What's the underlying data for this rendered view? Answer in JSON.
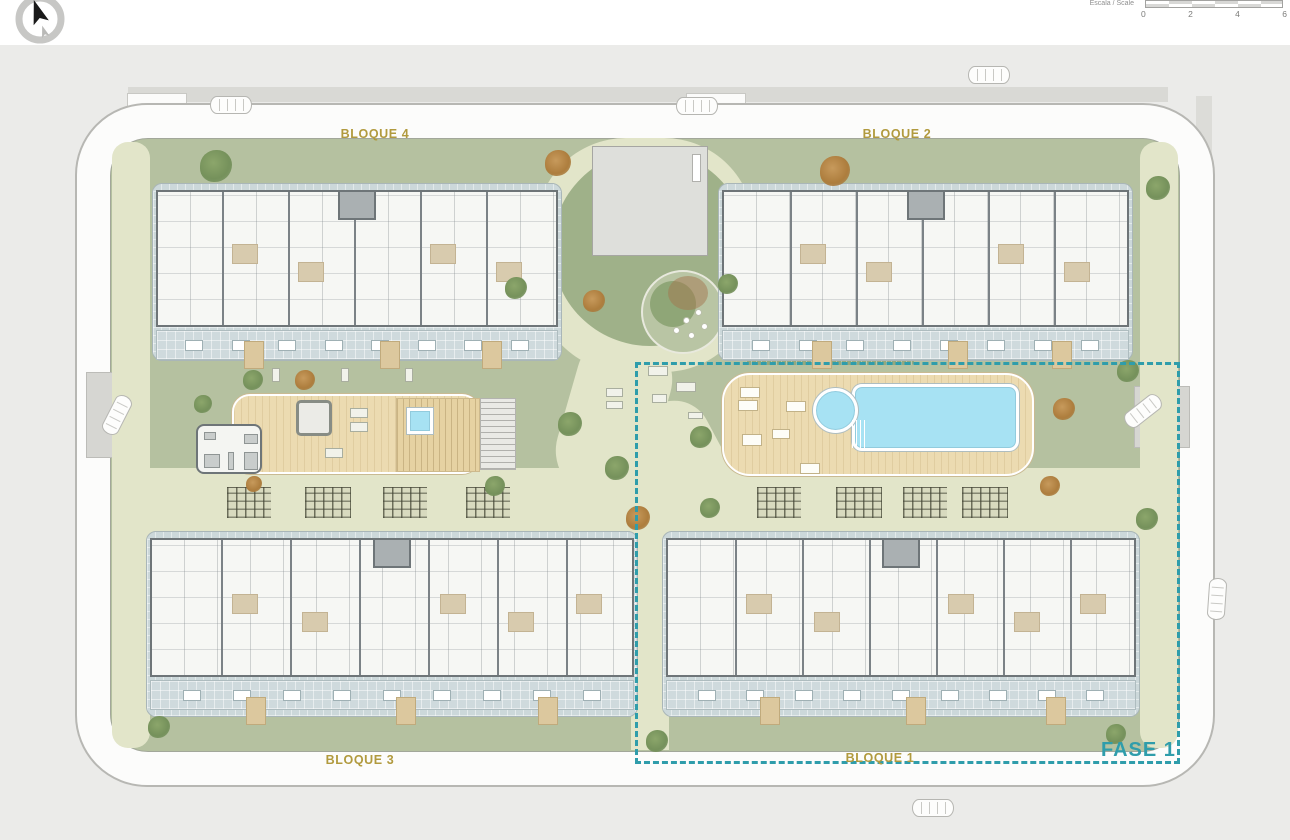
{
  "toolbar": {
    "compass_icon": "north-arrow",
    "scale": {
      "label": "Escala / Scale",
      "ticks": [
        "0",
        "2",
        "4",
        "6"
      ]
    }
  },
  "plan": {
    "blocks": [
      {
        "id": "bloque-4",
        "label": "BLOQUE 4",
        "position": "top-left"
      },
      {
        "id": "bloque-2",
        "label": "BLOQUE 2",
        "position": "top-right"
      },
      {
        "id": "bloque-3",
        "label": "BLOQUE 3",
        "position": "bottom-left"
      },
      {
        "id": "bloque-1",
        "label": "BLOQUE 1",
        "position": "bottom-right"
      }
    ],
    "phase": {
      "label": "FASE 1"
    }
  },
  "colors": {
    "block_label_gold": "#b19a3e",
    "phase_teal": "#2f9dab",
    "lawn_green": "#b5c1a0",
    "path_sage": "#e2e5c9",
    "pool_water": "#a7e2f3",
    "deck_wood": "#ecdbb1",
    "terrace_paving": "#ccd8da",
    "road_gray": "#d9d9d5"
  }
}
